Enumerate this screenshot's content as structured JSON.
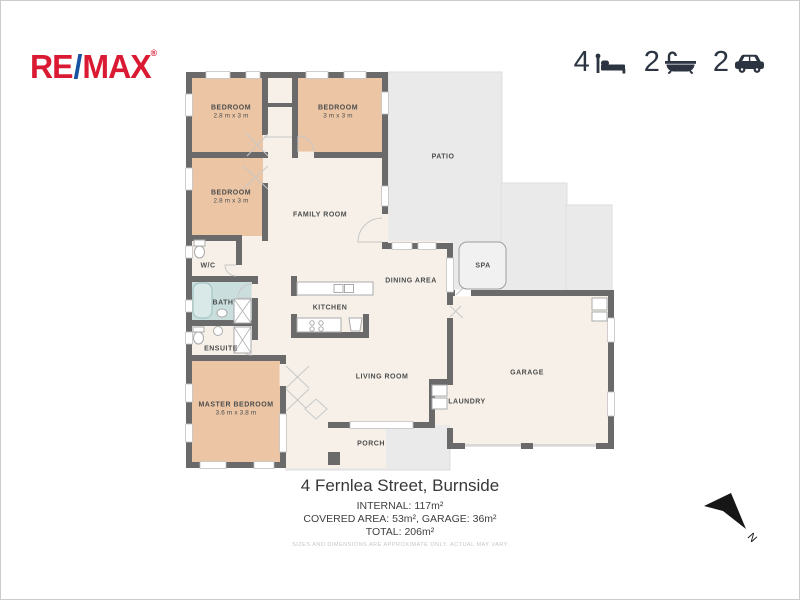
{
  "brand": {
    "logo_re": "RE",
    "logo_slash": "/",
    "logo_max": "MAX",
    "logo_reg": "®"
  },
  "stats": {
    "beds": {
      "value": "4",
      "icon": "bed-icon"
    },
    "baths": {
      "value": "2",
      "icon": "bath-icon"
    },
    "cars": {
      "value": "2",
      "icon": "car-icon"
    }
  },
  "plan": {
    "labels": {
      "bedroom1": {
        "name": "BEDROOM",
        "dims": "2.8 m x 3 m"
      },
      "bedroom2": {
        "name": "BEDROOM",
        "dims": "3 m x 3 m"
      },
      "bedroom3": {
        "name": "BEDROOM",
        "dims": "2.8 m x 3 m"
      },
      "family": {
        "name": "FAMILY ROOM"
      },
      "patio": {
        "name": "PATIO"
      },
      "wc": {
        "name": "W/C"
      },
      "bath": {
        "name": "BATH"
      },
      "ensuite": {
        "name": "ENSUITE"
      },
      "master": {
        "name": "MASTER BEDROOM",
        "dims": "3.6 m x 3.8 m"
      },
      "kitchen": {
        "name": "KITCHEN"
      },
      "dining": {
        "name": "DINING AREA"
      },
      "spa": {
        "name": "SPA"
      },
      "living": {
        "name": "LIVING ROOM"
      },
      "laundry": {
        "name": "LAUNDRY"
      },
      "garage": {
        "name": "GARAGE"
      },
      "porch": {
        "name": "PORCH"
      }
    },
    "compass": "N"
  },
  "footer": {
    "address": "4 Fernlea Street, Burnside",
    "internal": "INTERNAL: 117m²",
    "covered": "COVERED AREA: 53m², GARAGE: 36m²",
    "total": "TOTAL: 206m²",
    "disclaimer": "SIZES AND DIMENSIONS ARE APPROXIMATE ONLY. ACTUAL MAY VARY"
  },
  "colors": {
    "wall": "#6a6a6a",
    "floor": "#f6f0e8",
    "bedroom_fill": "#ebc5a4",
    "bath_fill": "#c9dedd",
    "outdoor_fill": "#eaeaea",
    "brand_red": "#da1a32",
    "brand_blue": "#1852a3",
    "stat_color": "#2b3440"
  }
}
